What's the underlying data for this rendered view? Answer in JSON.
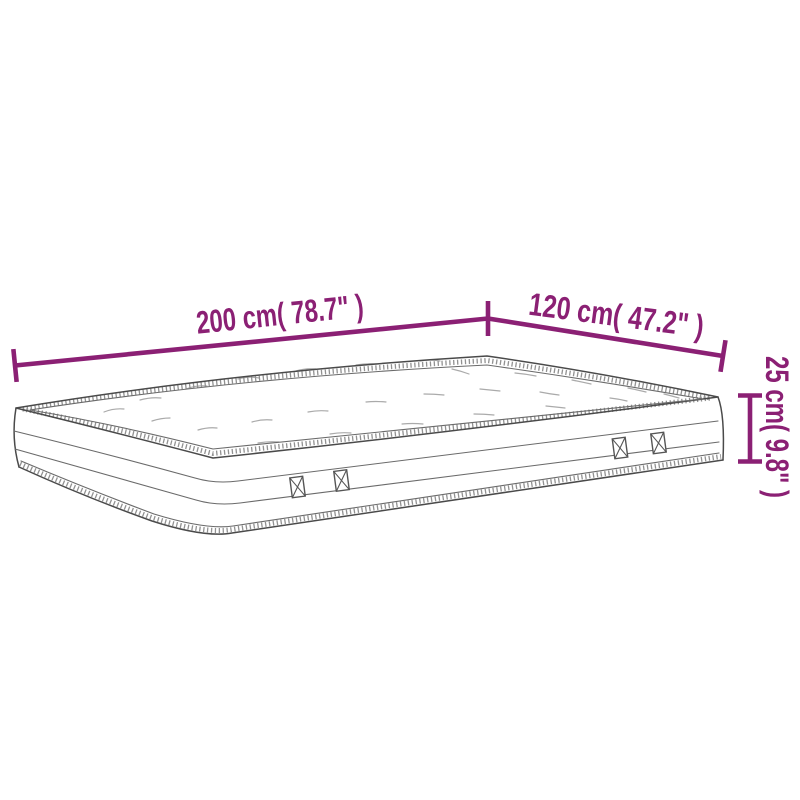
{
  "diagram": {
    "type": "product-dimensions",
    "product": "mattress"
  },
  "dimensions": {
    "length": {
      "label": "200 cm( 78.7\" )",
      "value_cm": "200 cm",
      "value_in": "78.7\""
    },
    "width": {
      "label": "120 cm( 47.2\" )",
      "value_cm": "120 cm",
      "value_in": "47.2\""
    },
    "height": {
      "label": "25 cm( 9.8\" )",
      "value_cm": "25 cm",
      "value_in": "9.8\""
    }
  },
  "colors": {
    "dimension_accent": "#8B2074",
    "line_art": "#4a4a4a",
    "background": "#ffffff"
  }
}
